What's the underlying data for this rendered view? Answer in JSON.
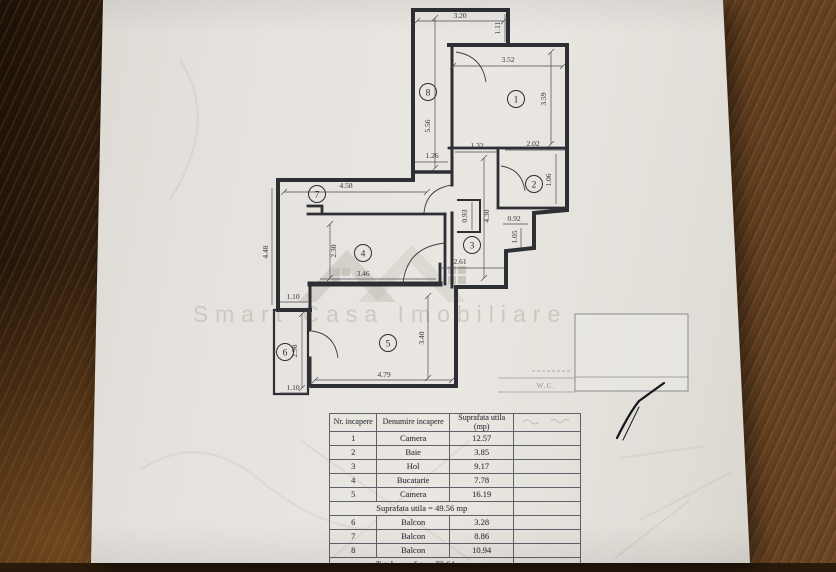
{
  "plan": {
    "room_numbers": [
      "1",
      "2",
      "3",
      "4",
      "5",
      "6",
      "7",
      "8"
    ],
    "dimensions": [
      {
        "label": "3.20"
      },
      {
        "label": "1.11"
      },
      {
        "label": "3.52"
      },
      {
        "label": "3.59"
      },
      {
        "label": "5.56"
      },
      {
        "label": "1.26"
      },
      {
        "label": "1.32"
      },
      {
        "label": "2.02"
      },
      {
        "label": "1.06"
      },
      {
        "label": "4.58"
      },
      {
        "label": "4.48"
      },
      {
        "label": "2.30"
      },
      {
        "label": "0.93"
      },
      {
        "label": "4.30"
      },
      {
        "label": "0.92"
      },
      {
        "label": "1.05"
      },
      {
        "label": "2.61"
      },
      {
        "label": "3.46"
      },
      {
        "label": "1.10"
      },
      {
        "label": "2.98"
      },
      {
        "label": "1.10"
      },
      {
        "label": "3.40"
      },
      {
        "label": "4.79"
      }
    ],
    "watermark_text": "Smart Casa Imobiliare",
    "wc_label": "W.C."
  },
  "table": {
    "headers": [
      "Nr. incapere",
      "Denumire incapere",
      "Suprafata utila (mp)",
      ""
    ],
    "rows": [
      {
        "nr": "1",
        "name": "Camera",
        "area": "12.57"
      },
      {
        "nr": "2",
        "name": "Baie",
        "area": "3.85"
      },
      {
        "nr": "3",
        "name": "Hol",
        "area": "9.17"
      },
      {
        "nr": "4",
        "name": "Bucatarie",
        "area": "7.78"
      },
      {
        "nr": "5",
        "name": "Camera",
        "area": "16.19"
      }
    ],
    "subtotal_label": "Suprafata utila = 49.56 mp",
    "balcony_rows": [
      {
        "nr": "6",
        "name": "Balcon",
        "area": "3.28"
      },
      {
        "nr": "7",
        "name": "Balcon",
        "area": "8.86"
      },
      {
        "nr": "8",
        "name": "Balcon",
        "area": "10.94"
      }
    ],
    "total_label": "Total suprafata = 72.64 mp"
  }
}
